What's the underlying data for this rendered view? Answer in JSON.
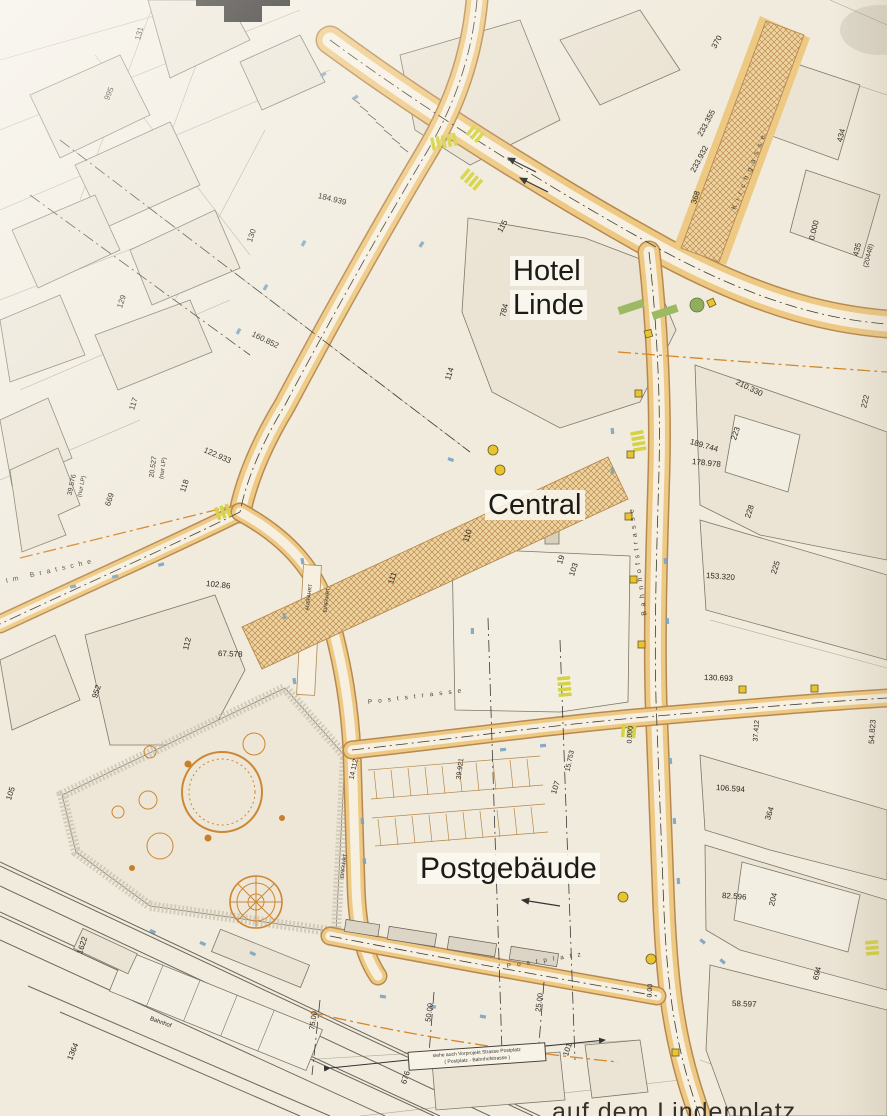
{
  "map": {
    "colors": {
      "paper": "#f1ebdd",
      "road_fill": "#eec983",
      "road_edge": "#b8894e",
      "road_inner": "#f7f0e0",
      "hatch_bg": "#ecd2a0",
      "hatch_line": "#b5813f",
      "building": "#ebe4d4",
      "building_edge": "#7d7767",
      "parcel_line": "#a39d88",
      "plaza": "#eee7d7",
      "plaza_ring": "#cbc4b3",
      "tree": "#cd8733",
      "signal": "#e8c42e",
      "crosswalk": "#d5d243",
      "blue": "#7aa3c2",
      "green": "#9db964",
      "ink": "#2b2722",
      "dash": "#3a3a3a",
      "orange_dash": "#d4862a",
      "rail": "#6b675e",
      "bay": "#dcd5c5"
    },
    "title_labels": [
      {
        "text": "Hotel",
        "x": 510,
        "y": 256,
        "size": 29
      },
      {
        "text": "Linde",
        "x": 510,
        "y": 290,
        "size": 29
      },
      {
        "text": "Central",
        "x": 485,
        "y": 490,
        "size": 29
      },
      {
        "text": "Postgebäude",
        "x": 417,
        "y": 853,
        "size": 30
      }
    ],
    "street_names": [
      {
        "text": "Im Bratsche",
        "x": 6,
        "y": 578,
        "rot": -13,
        "ls": 5,
        "size": 7
      },
      {
        "text": "Bahnhofstrasse",
        "x": 645,
        "y": 612,
        "rot": -97,
        "ls": 4.5,
        "size": 7
      },
      {
        "text": "Poststrasse",
        "x": 368,
        "y": 700,
        "rot": -7,
        "ls": 6,
        "size": 6.5
      },
      {
        "text": "Postplatz",
        "x": 507,
        "y": 964,
        "rot": -9,
        "ls": 6,
        "size": 6.5
      },
      {
        "text": "Kirchgasse",
        "x": 734,
        "y": 206,
        "rot": -68,
        "ls": 5,
        "size": 7
      }
    ],
    "labels": [
      {
        "t": "131",
        "x": 138,
        "y": 36,
        "r": -75
      },
      {
        "t": "995",
        "x": 107,
        "y": 96,
        "r": -68
      },
      {
        "t": "130",
        "x": 250,
        "y": 238,
        "r": -72
      },
      {
        "t": "184.939",
        "x": 318,
        "y": 192,
        "r": 14
      },
      {
        "t": "115",
        "x": 500,
        "y": 228,
        "r": -62
      },
      {
        "t": "370",
        "x": 714,
        "y": 44,
        "r": -62
      },
      {
        "t": "233.355",
        "x": 700,
        "y": 132,
        "r": -62
      },
      {
        "t": "233.932",
        "x": 693,
        "y": 168,
        "r": -62
      },
      {
        "t": "368",
        "x": 694,
        "y": 200,
        "r": -72
      },
      {
        "t": "434",
        "x": 840,
        "y": 138,
        "r": -76
      },
      {
        "t": "0.000",
        "x": 812,
        "y": 236,
        "r": -76
      },
      {
        "t": "435",
        "x": 856,
        "y": 252,
        "r": -76
      },
      {
        "t": "(20448)",
        "x": 866,
        "y": 264,
        "r": -76,
        "s": 7
      },
      {
        "t": "210.330",
        "x": 736,
        "y": 378,
        "r": 26
      },
      {
        "t": "222",
        "x": 864,
        "y": 404,
        "r": -76
      },
      {
        "t": "223",
        "x": 734,
        "y": 436,
        "r": -72
      },
      {
        "t": "189.744",
        "x": 690,
        "y": 438,
        "r": 16
      },
      {
        "t": "178.978",
        "x": 692,
        "y": 458,
        "r": 6
      },
      {
        "t": "228",
        "x": 748,
        "y": 514,
        "r": -72
      },
      {
        "t": "225",
        "x": 774,
        "y": 570,
        "r": -72
      },
      {
        "t": "153.320",
        "x": 706,
        "y": 572,
        "r": 4
      },
      {
        "t": "129",
        "x": 120,
        "y": 304,
        "r": -72
      },
      {
        "t": "160.852",
        "x": 252,
        "y": 330,
        "r": 26
      },
      {
        "t": "117",
        "x": 132,
        "y": 406,
        "r": -72
      },
      {
        "t": "122.933",
        "x": 204,
        "y": 446,
        "r": 24
      },
      {
        "t": "39.576",
        "x": 70,
        "y": 492,
        "r": -78,
        "s": 7
      },
      {
        "t": "(nur LP)",
        "x": 80,
        "y": 494,
        "r": -78,
        "s": 6
      },
      {
        "t": "20.527",
        "x": 152,
        "y": 474,
        "r": -82,
        "s": 7
      },
      {
        "t": "(nur LP)",
        "x": 162,
        "y": 476,
        "r": -82,
        "s": 6
      },
      {
        "t": "118",
        "x": 183,
        "y": 488,
        "r": -72
      },
      {
        "t": "669",
        "x": 108,
        "y": 502,
        "r": -72
      },
      {
        "t": "102.86",
        "x": 206,
        "y": 580,
        "r": 6
      },
      {
        "t": "114",
        "x": 448,
        "y": 376,
        "r": -72
      },
      {
        "t": "784",
        "x": 503,
        "y": 313,
        "r": -76
      },
      {
        "t": "110",
        "x": 466,
        "y": 538,
        "r": -72
      },
      {
        "t": "111",
        "x": 391,
        "y": 580,
        "r": -72
      },
      {
        "t": "19",
        "x": 560,
        "y": 560,
        "r": -72
      },
      {
        "t": "103",
        "x": 572,
        "y": 572,
        "r": -72
      },
      {
        "t": "952",
        "x": 95,
        "y": 694,
        "r": -72
      },
      {
        "t": "112",
        "x": 186,
        "y": 646,
        "r": -76
      },
      {
        "t": "67.578",
        "x": 218,
        "y": 650,
        "r": 2
      },
      {
        "t": "105",
        "x": 9,
        "y": 796,
        "r": -72
      },
      {
        "t": "AUSFAHRT",
        "x": 308,
        "y": 608,
        "r": -82,
        "s": 5
      },
      {
        "t": "EINFAHRT",
        "x": 326,
        "y": 610,
        "r": -82,
        "s": 5
      },
      {
        "t": "EINFAHRT",
        "x": 343,
        "y": 876,
        "r": -82,
        "s": 5
      },
      {
        "t": "14.112",
        "x": 352,
        "y": 776,
        "r": -78,
        "s": 7
      },
      {
        "t": "39.921",
        "x": 459,
        "y": 776,
        "r": -82,
        "s": 7
      },
      {
        "t": "107",
        "x": 554,
        "y": 790,
        "r": -72
      },
      {
        "t": "15.753",
        "x": 568,
        "y": 768,
        "r": -78,
        "s": 7
      },
      {
        "t": "130.693",
        "x": 704,
        "y": 674,
        "r": 2
      },
      {
        "t": "54.823",
        "x": 872,
        "y": 740,
        "r": -86
      },
      {
        "t": "37.412",
        "x": 756,
        "y": 738,
        "r": -86,
        "s": 7
      },
      {
        "t": "106.594",
        "x": 716,
        "y": 784,
        "r": 4
      },
      {
        "t": "364",
        "x": 768,
        "y": 816,
        "r": -72
      },
      {
        "t": "82.596",
        "x": 722,
        "y": 892,
        "r": 4
      },
      {
        "t": "204",
        "x": 772,
        "y": 902,
        "r": -76
      },
      {
        "t": "58.597",
        "x": 732,
        "y": 1000,
        "r": 2
      },
      {
        "t": "694",
        "x": 816,
        "y": 976,
        "r": -76
      },
      {
        "t": "0.000",
        "x": 630,
        "y": 740,
        "r": -86,
        "s": 7
      },
      {
        "t": "0.00",
        "x": 650,
        "y": 994,
        "r": -86,
        "s": 7
      },
      {
        "t": "75.00",
        "x": 312,
        "y": 1026,
        "r": -82,
        "s": 7.5
      },
      {
        "t": "50.00",
        "x": 428,
        "y": 1018,
        "r": -82,
        "s": 7.5
      },
      {
        "t": "25.00",
        "x": 538,
        "y": 1008,
        "r": -82,
        "s": 7.5
      },
      {
        "t": "1622",
        "x": 80,
        "y": 950,
        "r": -72
      },
      {
        "t": "1364",
        "x": 70,
        "y": 1056,
        "r": -68
      },
      {
        "t": "Bahnhof",
        "x": 150,
        "y": 1016,
        "r": 20,
        "s": 6
      },
      {
        "t": "676",
        "x": 404,
        "y": 1080,
        "r": -72
      },
      {
        "t": "101",
        "x": 566,
        "y": 1052,
        "r": -72
      }
    ],
    "note_box": {
      "line1": "siehe auch Vorprojekt Strasse Postplatz",
      "line2": "( Postplatz - Bahnhofstrasse )"
    },
    "caption_fragment": "auf dem Lindenplatz"
  }
}
